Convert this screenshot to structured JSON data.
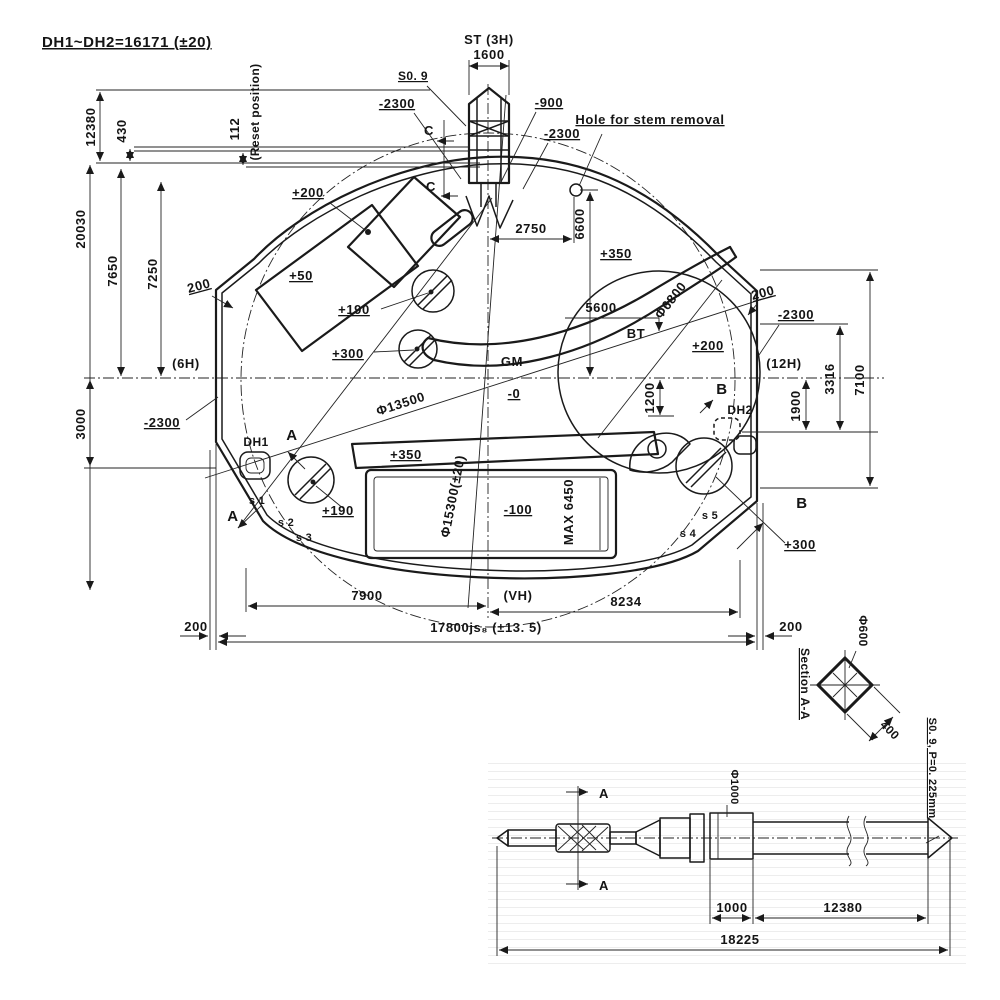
{
  "colors": {
    "ink": "#1a1a1a",
    "bg": "#ffffff",
    "ruled": "#ededed"
  },
  "title": "DH1~DH2=16171 (±20)",
  "top": {
    "st": "ST (3H)",
    "w1600": "1600",
    "s09": "S0. 9",
    "m2300a": "-2300",
    "m900": "-900",
    "m2300b": "-2300",
    "c1": "C",
    "c2": "C",
    "hole_note": "Hole for stem removal",
    "d2750": "2750",
    "d6600": "6600"
  },
  "left": {
    "d12380": "12380",
    "d430": "430",
    "d112": "112",
    "reset": "(Reset position)",
    "d20030": "20030",
    "d7650": "7650",
    "d7250": "7250",
    "d3000": "3000",
    "e200": "200",
    "h6": "(6H)",
    "m2300": "-2300"
  },
  "plate": {
    "p200": "+200",
    "p50": "+50",
    "p190u": "+190",
    "p300u": "+300",
    "gm": "GM",
    "p350u": "+350",
    "dia6800": "Φ6800",
    "d5600": "5600",
    "bt": "BT",
    "p200r": "+200",
    "b1": "B",
    "b2": "B",
    "dh1": "DH1",
    "dh2": "DH2",
    "a1": "A",
    "a2": "A",
    "m0": "-0",
    "dia13500": "Φ13500",
    "p350l": "+350",
    "dia15300": "Φ15300(±20)",
    "m100": "-100",
    "max": "MAX 6450",
    "p190l": "+190",
    "p300l": "+300",
    "d1200": "1200",
    "s1": "s 1",
    "s2": "s 2",
    "s3": "s 3",
    "s4": "s 4",
    "s5": "s 5"
  },
  "right": {
    "e200": "200",
    "m2300": "-2300",
    "h12": "(12H)",
    "d3316": "3316",
    "d7100": "7100",
    "d1900": "1900"
  },
  "bottom": {
    "d7900": "7900",
    "vh": "(VH)",
    "d8234": "8234",
    "l200": "200",
    "r200": "200",
    "total": "17800js₈ (±13. 5)"
  },
  "section": {
    "label": "Section A-A",
    "dia600": "Φ600",
    "d400": "400",
    "spec": "S0. 9, P=0. 225mm"
  },
  "stem": {
    "aTop": "A",
    "aBot": "A",
    "dia1000": "Φ1000",
    "d1000": "1000",
    "d12380": "12380",
    "d18225": "18225"
  }
}
